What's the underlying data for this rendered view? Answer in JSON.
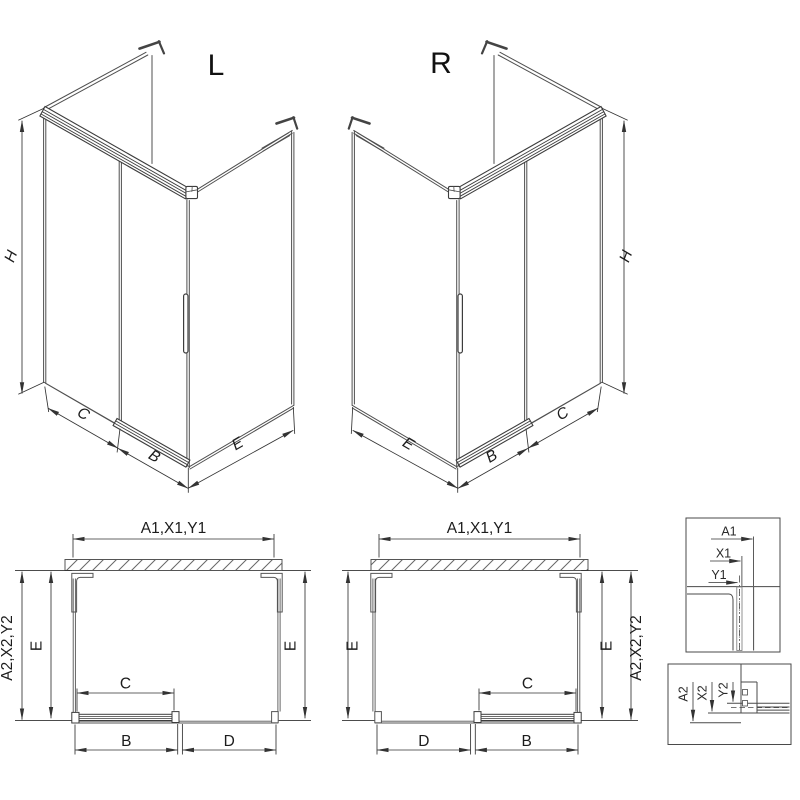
{
  "iso_left": {
    "label": "L",
    "dim_h": "H",
    "dim_c": "C",
    "dim_b": "B",
    "dim_e": "E"
  },
  "iso_right": {
    "label": "R",
    "dim_h": "H",
    "dim_c": "C",
    "dim_b": "B",
    "dim_e": "E"
  },
  "plan_left": {
    "dim_top": "A1,X1,Y1",
    "dim_side": "A2,X2,Y2",
    "dim_e_left": "E",
    "dim_e_right": "E",
    "dim_c": "C",
    "dim_b": "B",
    "dim_d": "D"
  },
  "plan_right": {
    "dim_top": "A1,X1,Y1",
    "dim_side": "A2,X2,Y2",
    "dim_e_left": "E",
    "dim_e_right": "E",
    "dim_c": "C",
    "dim_b": "B",
    "dim_d": "D"
  },
  "detail_top": {
    "dim_a1": "A1",
    "dim_x1": "X1",
    "dim_y1": "Y1"
  },
  "detail_bottom": {
    "dim_a2": "A2",
    "dim_x2": "X2",
    "dim_y2": "Y2"
  },
  "colors": {
    "background": "#ffffff",
    "glass_line": "#4f4f4f",
    "frame_line": "#3d3d3d",
    "dimension_line": "#333333",
    "text": "#1a1a1a",
    "hatch": "#666666"
  }
}
